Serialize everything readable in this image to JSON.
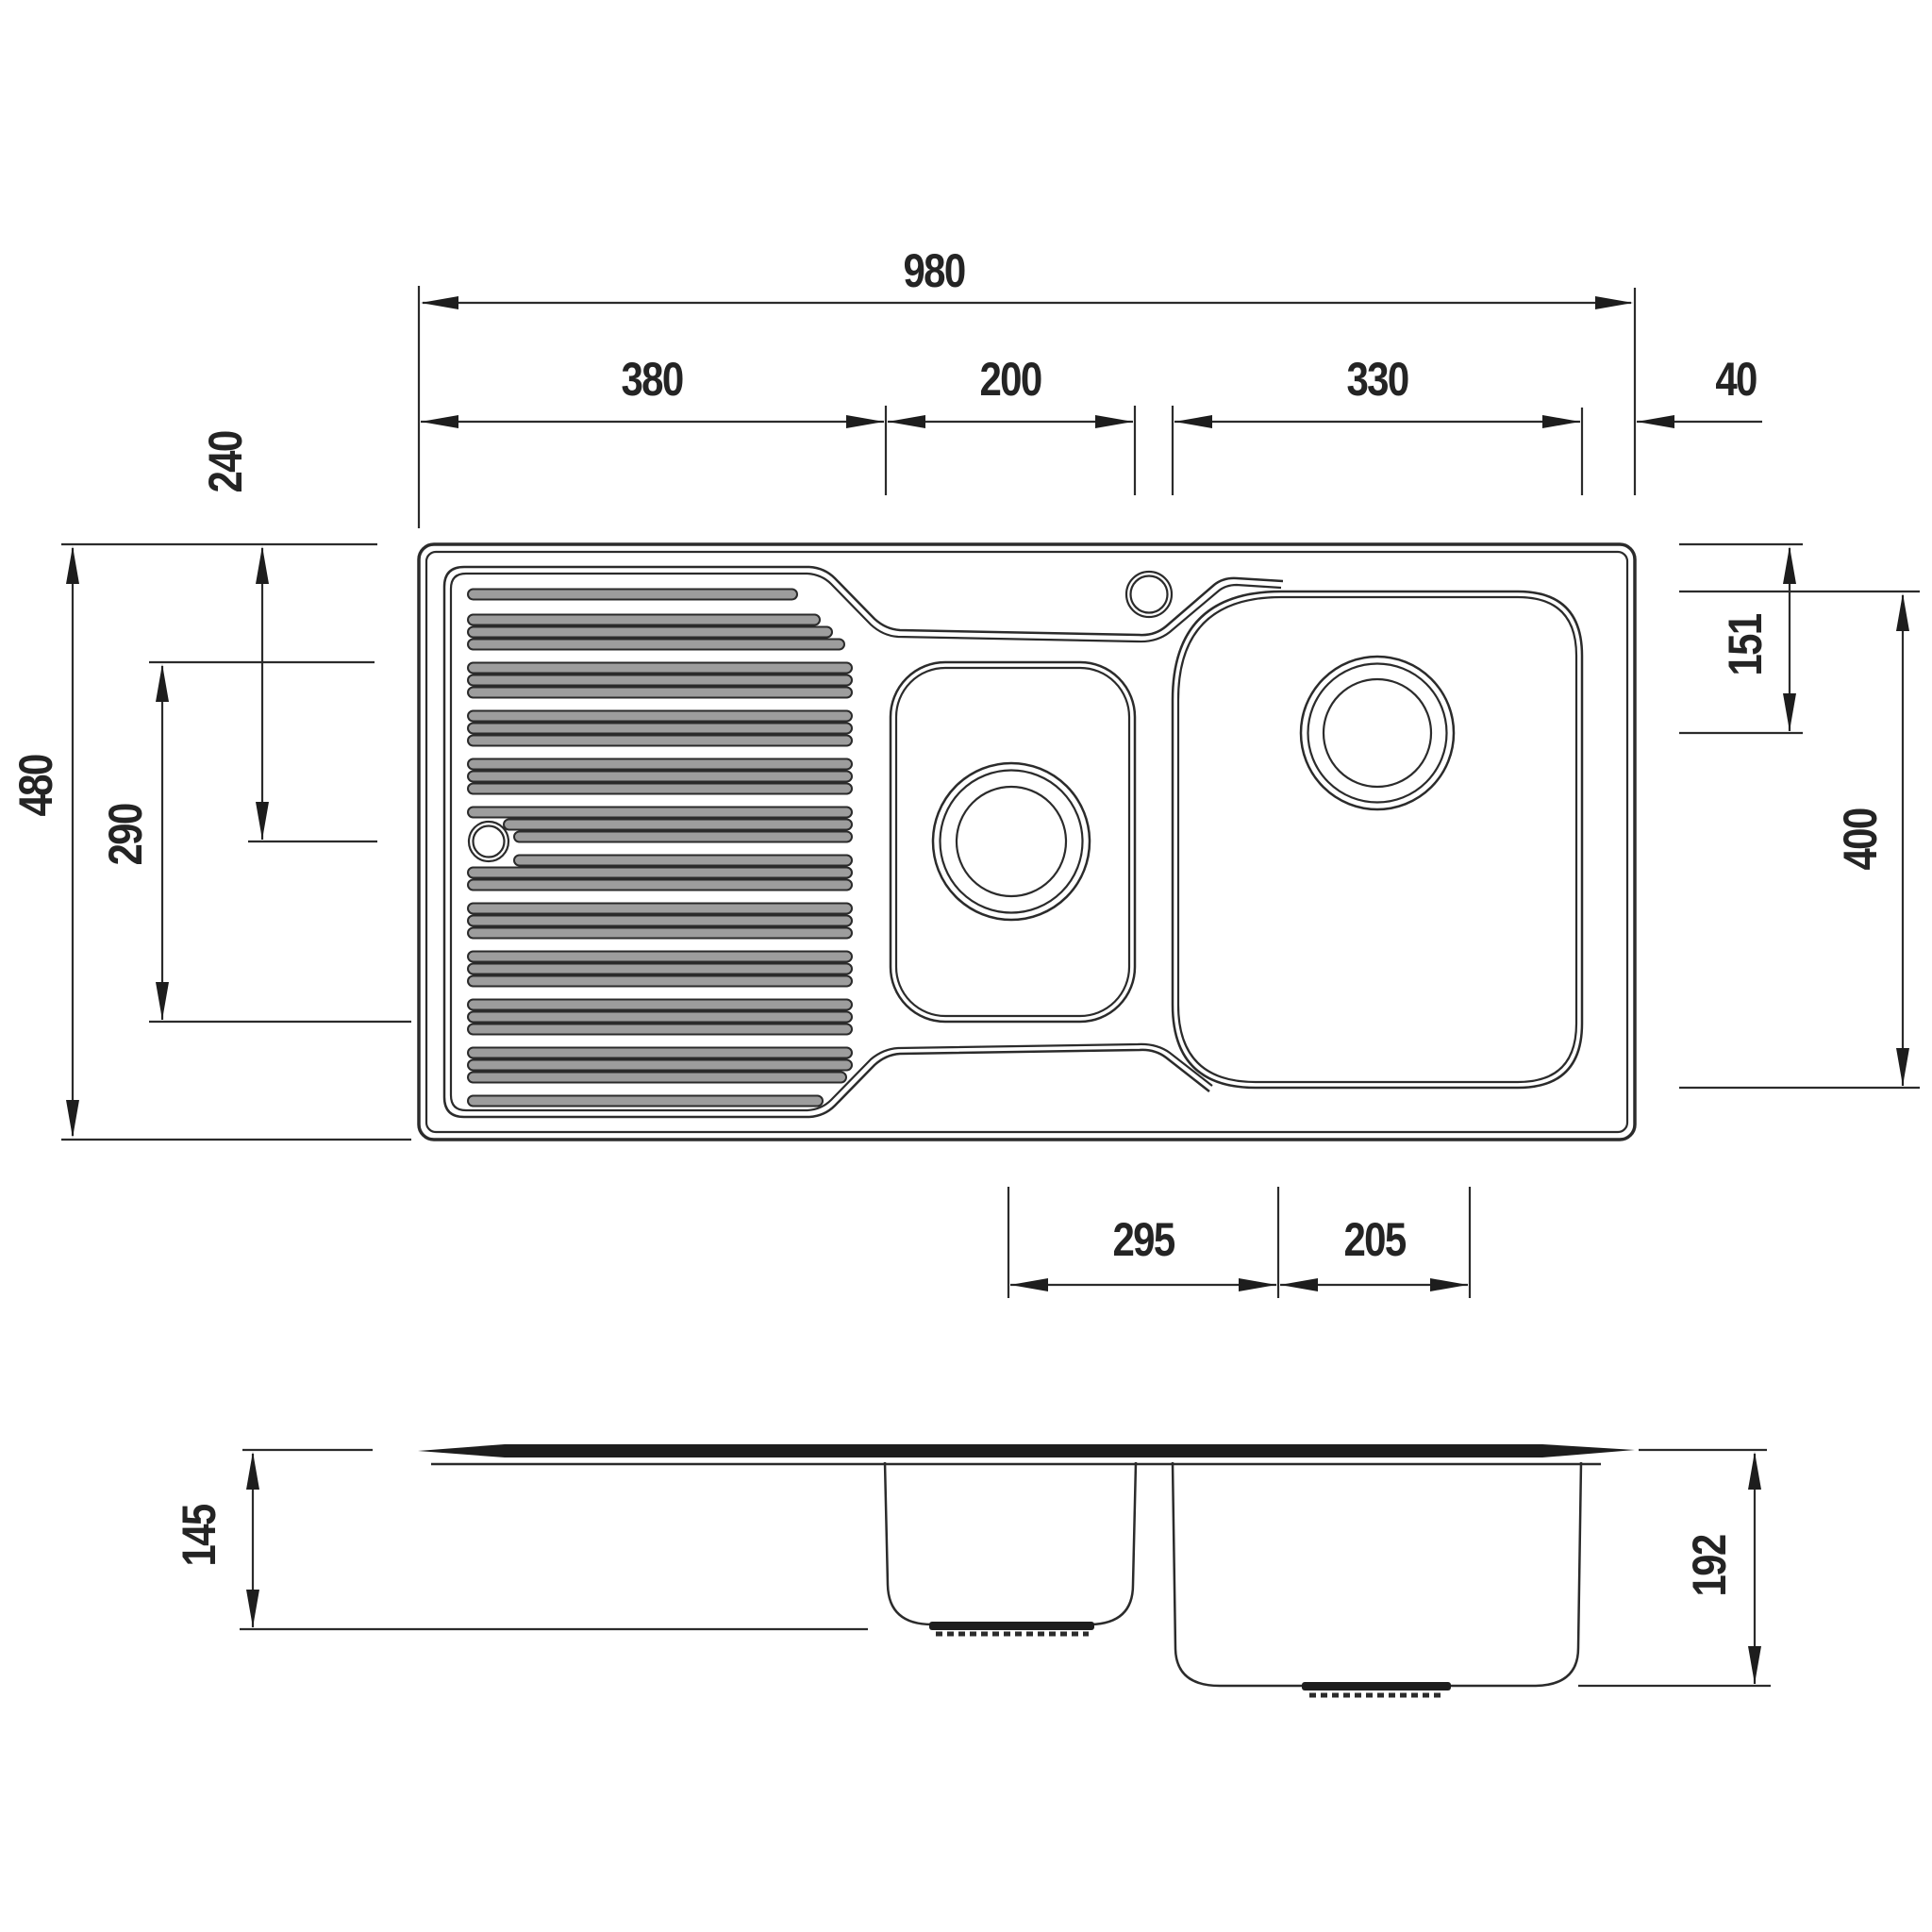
{
  "drawing": {
    "background": "#ffffff",
    "line_color": "#2b2b2b",
    "units": "mm",
    "dimensions": {
      "top_row": {
        "overall_width": "980",
        "drainer_width": "380",
        "small_bowl_width": "200",
        "large_bowl_width": "330",
        "right_edge_margin": "40"
      },
      "left_column": {
        "rim_to_small_drain": "240",
        "small_bowl_length": "290",
        "overall_depth": "480"
      },
      "right_column": {
        "rim_to_large_drain": "151",
        "large_bowl_length": "400"
      },
      "bottom_row": {
        "drain_centre_spacing": "295",
        "drain_to_right_edge": "205"
      },
      "side_view": {
        "small_bowl_depth": "145",
        "large_bowl_depth": "192"
      }
    }
  }
}
